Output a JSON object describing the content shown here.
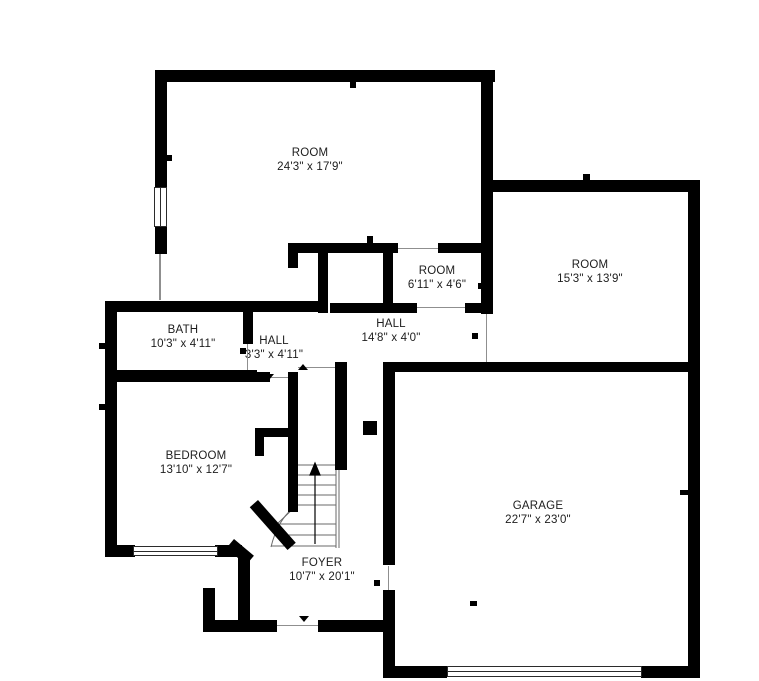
{
  "type": "floor-plan",
  "colors": {
    "walls": "#000000",
    "background": "#ffffff",
    "text": "#1d1d1d"
  },
  "rooms": [
    {
      "name": "ROOM",
      "dims": "24'3\" x 17'9\""
    },
    {
      "name": "ROOM",
      "dims": "6'11\" x 4'6\""
    },
    {
      "name": "ROOM",
      "dims": "15'3\" x 13'9\""
    },
    {
      "name": "BATH",
      "dims": "10'3\" x 4'11\""
    },
    {
      "name": "HALL",
      "dims": "3'3\" x 4'11\""
    },
    {
      "name": "HALL",
      "dims": "14'8\" x 4'0\""
    },
    {
      "name": "BEDROOM",
      "dims": "13'10\" x 12'7\""
    },
    {
      "name": "GARAGE",
      "dims": "22'7\" x 23'0\""
    },
    {
      "name": "FOYER",
      "dims": "10'7\" x 20'1\""
    }
  ],
  "features": {
    "staircase_direction": "up",
    "windows": [
      "top-left-room-west-wall",
      "bedroom-south-wall"
    ],
    "garage_door": "south-wall"
  }
}
